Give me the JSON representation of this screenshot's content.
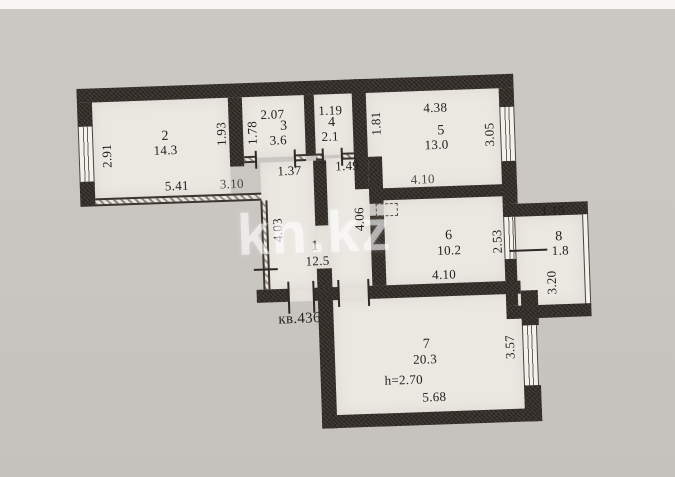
{
  "plan": {
    "apartment_label": "кв.436",
    "watermark": "kn.kz",
    "rooms": {
      "hall": {
        "number": "1",
        "area": "12.5",
        "dims": {
          "top_left": "1.37",
          "top_right": "1.49",
          "left": "4.03",
          "right": "4.06"
        }
      },
      "room2": {
        "number": "2",
        "area": "14.3",
        "dims": {
          "left": "2.91",
          "right": "1.93",
          "bottom": "5.41",
          "bottom_right": "3.10"
        }
      },
      "room3": {
        "number": "3",
        "area": "3.6",
        "dims": {
          "top": "2.07",
          "left": "1.78"
        }
      },
      "room4": {
        "number": "4",
        "area": "2.1",
        "dims": {
          "top": "1.19",
          "right": "1.81"
        }
      },
      "room5": {
        "number": "5",
        "area": "13.0",
        "dims": {
          "top": "4.38",
          "right": "3.05",
          "bottom": "4.10"
        }
      },
      "room6": {
        "number": "6",
        "area": "10.2",
        "dims": {
          "bottom": "4.10",
          "right": "2.53"
        }
      },
      "room7": {
        "number": "7",
        "area": "20.3",
        "ceiling_height": "h=2.70",
        "dims": {
          "bottom": "5.68",
          "right": "3.57"
        }
      },
      "room8": {
        "number": "8",
        "area": "1.8",
        "dims": {
          "top": "1.15",
          "left": "3.20"
        }
      }
    }
  }
}
